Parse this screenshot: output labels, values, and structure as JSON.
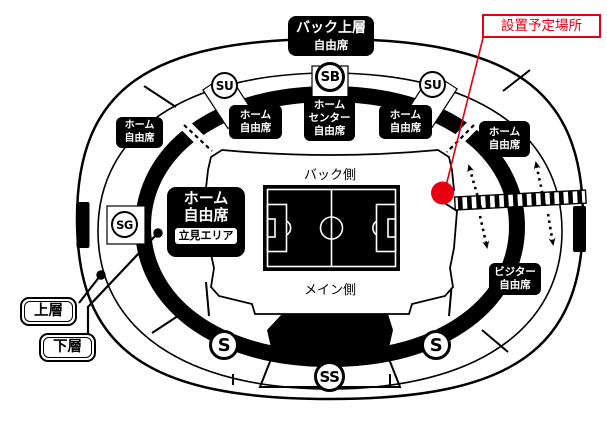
{
  "note": {
    "label": "設置予定場所"
  },
  "colors": {
    "accent": "#e60012",
    "ink": "#000000"
  },
  "gates": {
    "su_left": "SU",
    "sb": "SB",
    "su_right": "SU",
    "sg": "SG",
    "s_left": "S",
    "s_right": "S",
    "ss": "SS"
  },
  "seats": {
    "back_upper": {
      "line1": "バック上層",
      "line2": "自由席"
    },
    "home_far_left": {
      "line1": "ホーム",
      "line2": "自由席"
    },
    "home_back_left": {
      "line1": "ホーム",
      "line2": "自由席"
    },
    "home_back_center": {
      "line1": "ホーム",
      "line2": "センター",
      "line3": "自由席"
    },
    "home_back_right": {
      "line1": "ホーム",
      "line2": "自由席"
    },
    "home_far_right": {
      "line1": "ホーム",
      "line2": "自由席"
    },
    "home_main": {
      "line1": "ホーム",
      "line2": "自由席",
      "standing": "立見エリア"
    },
    "visitor": {
      "line1": "ビジター",
      "line2": "自由席"
    }
  },
  "sides": {
    "back": "バック側",
    "main": "メイン側"
  },
  "tiers": {
    "upper": "上層",
    "lower": "下層"
  }
}
